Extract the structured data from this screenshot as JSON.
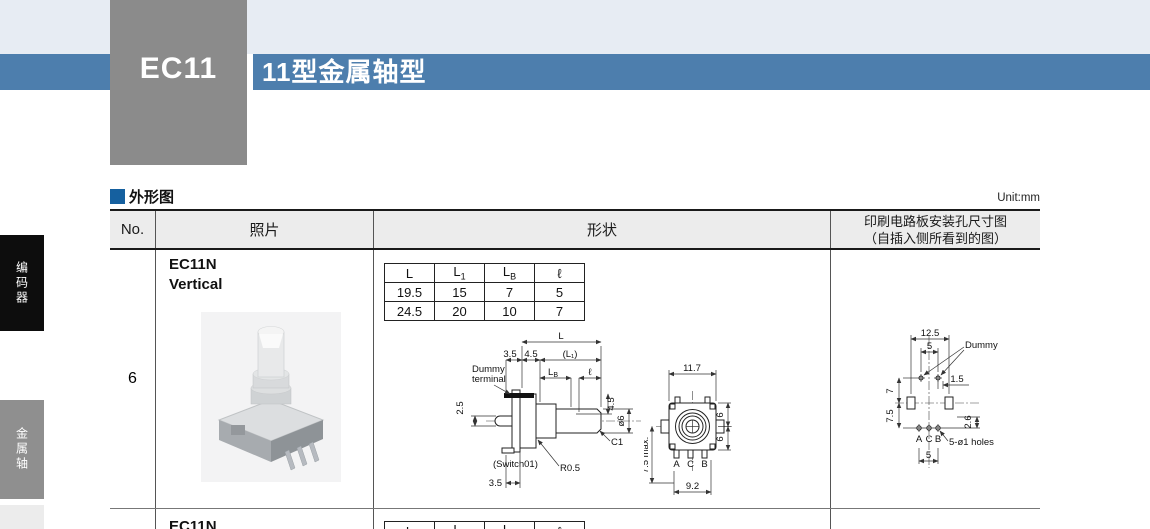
{
  "colors": {
    "top_band": "#e7ecf3",
    "title_bar_blue": "#4d7ead",
    "code_box_gray": "#8b8b8b",
    "section_square_blue": "#15609f",
    "tab_black": "#0d0d0d",
    "tab_gray": "#8f8f8f"
  },
  "banner": {
    "code": "EC11",
    "title": "11型金属轴型"
  },
  "sidebar": {
    "tab_encoder": "编码器",
    "tab_metal_shaft": "金属轴"
  },
  "section": {
    "title": "外形图",
    "unit": "Unit:mm"
  },
  "table": {
    "headers": {
      "no": "No.",
      "photo": "照片",
      "shape": "形状",
      "pcb1": "印刷电路板安装孔尺寸图",
      "pcb2": "（自插入侧所看到的图）"
    },
    "row6": {
      "no": "6",
      "model": "EC11N",
      "variant": "Vertical",
      "dims": {
        "c1": "L",
        "c2m": "L",
        "c2s": "1",
        "c3m": "L",
        "c3s": "B",
        "c4": "ℓ",
        "r1": [
          "19.5",
          "15",
          "7",
          "5"
        ],
        "r2": [
          "24.5",
          "20",
          "10",
          "7"
        ]
      }
    },
    "row7": {
      "model": "EC11N"
    }
  },
  "side_view": {
    "l": "L",
    "d35top": "3.5",
    "d45top": "4.5",
    "l1": "(L₁)",
    "dummy1": "Dummy",
    "dummy2": "terminal",
    "lbm": "L",
    "lbs": "B",
    "ell": "ℓ",
    "d45v": "4.5",
    "dia6": "ø6",
    "d25": "2.5",
    "c1": "C1",
    "switch": "(Switch01)",
    "r05": "R0.5",
    "d35bot": "3.5"
  },
  "front_view": {
    "d117": "11.7",
    "d6top": "6",
    "d6bot": "6",
    "d75max": "7.5 max.",
    "a": "A",
    "c": "C",
    "b": "B",
    "d92": "9.2"
  },
  "pcb_view": {
    "d125": "12.5",
    "d5top": "5",
    "dummy": "Dummy",
    "d15": "1.5",
    "d7": "7",
    "d75": "7.5",
    "d26": "2.6",
    "a": "A",
    "c": "C",
    "b": "B",
    "holes": "5-ø1 holes",
    "d5bot": "5"
  }
}
